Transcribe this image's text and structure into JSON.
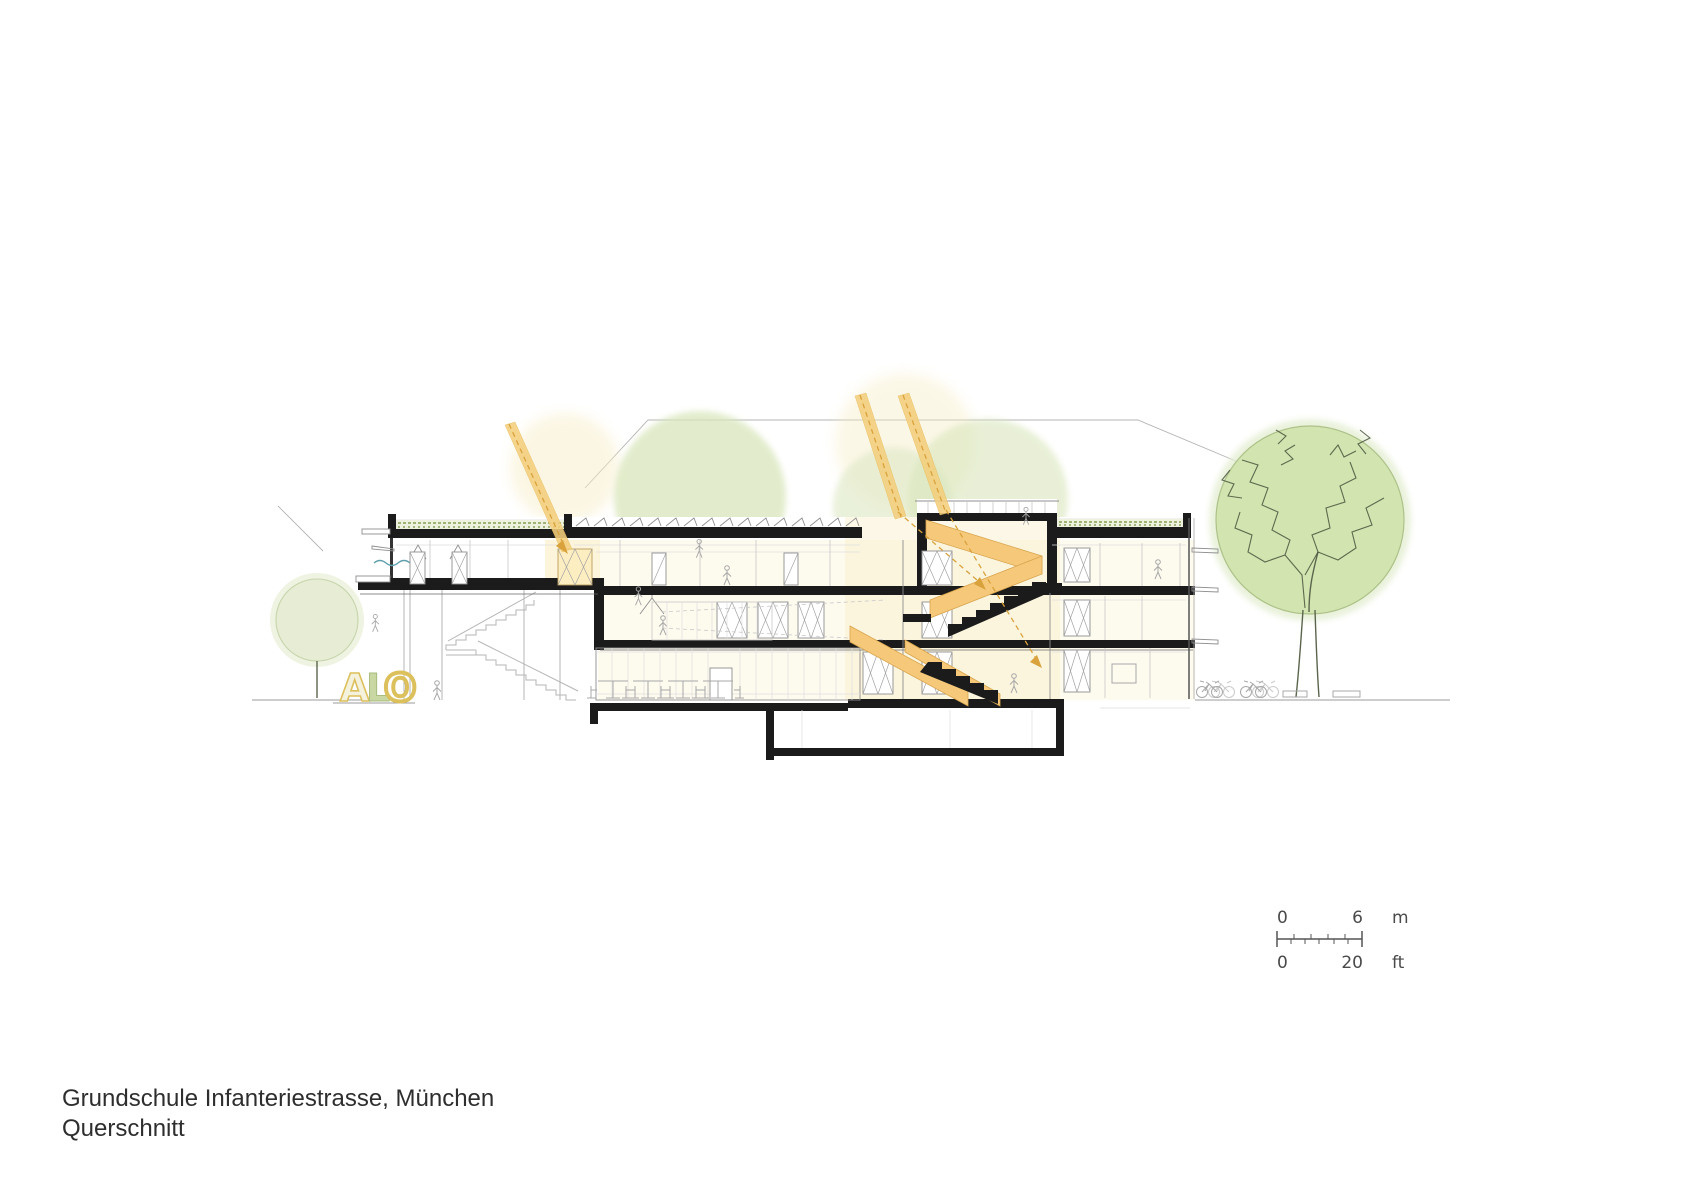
{
  "document": {
    "type": "architectural section drawing"
  },
  "title": {
    "line1": "Grundschule Infanteriestrasse, München",
    "line2": "Querschnitt"
  },
  "scale_bar": {
    "meters": {
      "start": "0",
      "end": "6",
      "unit": "m"
    },
    "feet": {
      "start": "0",
      "end": "20",
      "unit": "ft"
    }
  },
  "play_letters": {
    "a": "A",
    "l": "L",
    "o": "O"
  },
  "colors": {
    "sun_beam": "#f4cf7d",
    "sun_beam_dash": "#d9a23c",
    "stair_orange": "#f6c87a",
    "tree_fill": "#cfe2ab",
    "tree_soft": "#d9e6bc",
    "roof_slab": "#1b1b1b",
    "wash_yellow": "#fcf6e0",
    "letter_yellow": "#dcc05c",
    "letter_green": "#c9d8a2",
    "line_gray": "#9b9b9b",
    "text_dark": "#2e2e2e"
  }
}
